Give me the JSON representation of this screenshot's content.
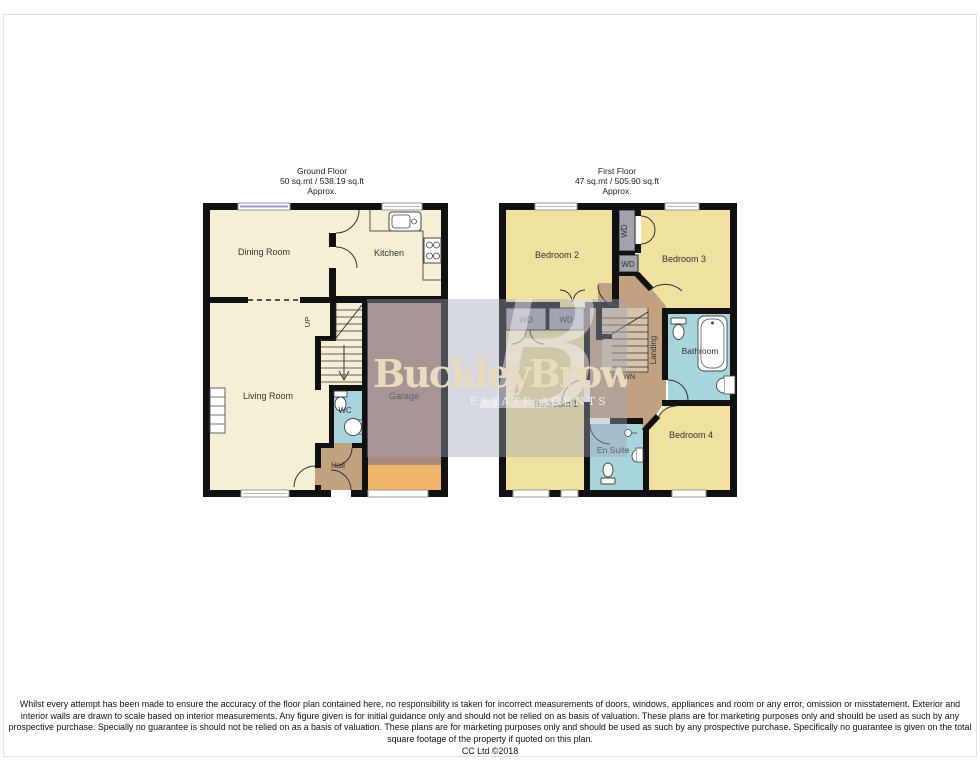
{
  "ground_floor": {
    "title": "Ground Floor",
    "area": "50 sq.mt / 538.19 sq.ft",
    "approx": "Approx.",
    "rooms": {
      "dining": "Dining Room",
      "kitchen": "Kitchen",
      "living": "Living Room",
      "garage": "Garage",
      "wc": "WC",
      "hall": "Hall"
    },
    "stairs_label": "UP"
  },
  "first_floor": {
    "title": "First Floor",
    "area": "47 sq.mt / 505.90 sq.ft",
    "approx": "Approx.",
    "rooms": {
      "bedroom1": "Bedroom 1",
      "bedroom2": "Bedroom 2",
      "bedroom3": "Bedroom 3",
      "bedroom4": "Bedroom 4",
      "bathroom": "Bathroom",
      "en_suite": "En Suite",
      "landing": "Landing",
      "wd": "WD"
    },
    "stairs_label": "DOWN"
  },
  "watermark": {
    "monogram": "B",
    "brand": "BuckleyBrown",
    "tagline": "ESTATE AGENTS"
  },
  "footer": {
    "disclaimer": "Whilst every attempt has been made to ensure the accuracy of the floor plan contained here, no responsibility is taken for incorrect measurements of doors, windows, appliances and room or any error, omission or misstatement. Exterior and interior walls are drawn to scale based on interior measurements. Any figure given is for initial guidance only and should not be relied on as basis of valuation. These plans are for marketing purposes only and should be used as such by any prospective purchase. Specially no guarantee is should not be relied on as a basis of valuation. These plans are for marketing purposes only and should be used as such by any prospective purchase. Specifically no guarantee is given on the total square footage of the property if quoted on this plan.",
    "copyright": "CC Ltd ©2018"
  },
  "colors": {
    "room_cream": "#F5EFD5",
    "bedroom_yellow": "#F1E1A0",
    "garage_brown": "#AD8B7C",
    "hall_tan": "#C2A181",
    "bath_blue": "#A7D5DB",
    "wd_gray": "#A2A3AB",
    "stair_beige": "#D6C3A9",
    "garage_door_orange": "#EFB469",
    "wall": "#111111",
    "window_blue": "#8A8AD8",
    "watermark_overlay": "rgba(160,164,184,0.42)"
  }
}
